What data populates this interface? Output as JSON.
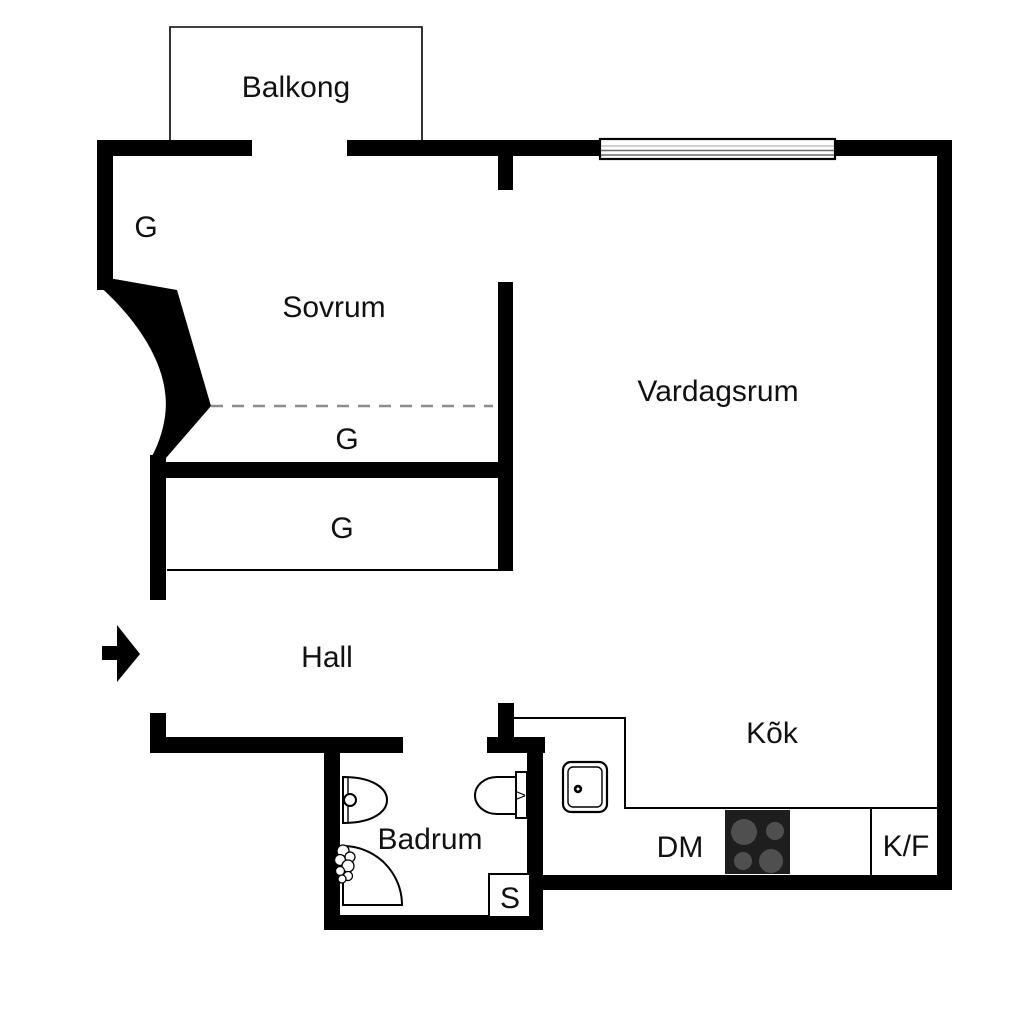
{
  "floorplan": {
    "rooms": {
      "balcony": "Balkong",
      "bedroom": "Sovrum",
      "living_room": "Vardagsrum",
      "hall": "Hall",
      "bathroom": "Badrum",
      "kitchen": "Kõk"
    },
    "labels": {
      "wardrobe_top": "G",
      "wardrobe_middle": "G",
      "wardrobe_lower": "G",
      "dishwasher": "DM",
      "fridge_freezer": "K/F",
      "cabinet": "S",
      "toilet_mark": ">"
    },
    "colors": {
      "background": "#ffffff",
      "wall": "#000000",
      "dashed_line": "#8c8c8c",
      "stove": "#1e1e1e",
      "burner": "#4f4f4f",
      "window_line_light": "#c0c0c0",
      "window_line_dark": "#6a6a6a"
    }
  }
}
